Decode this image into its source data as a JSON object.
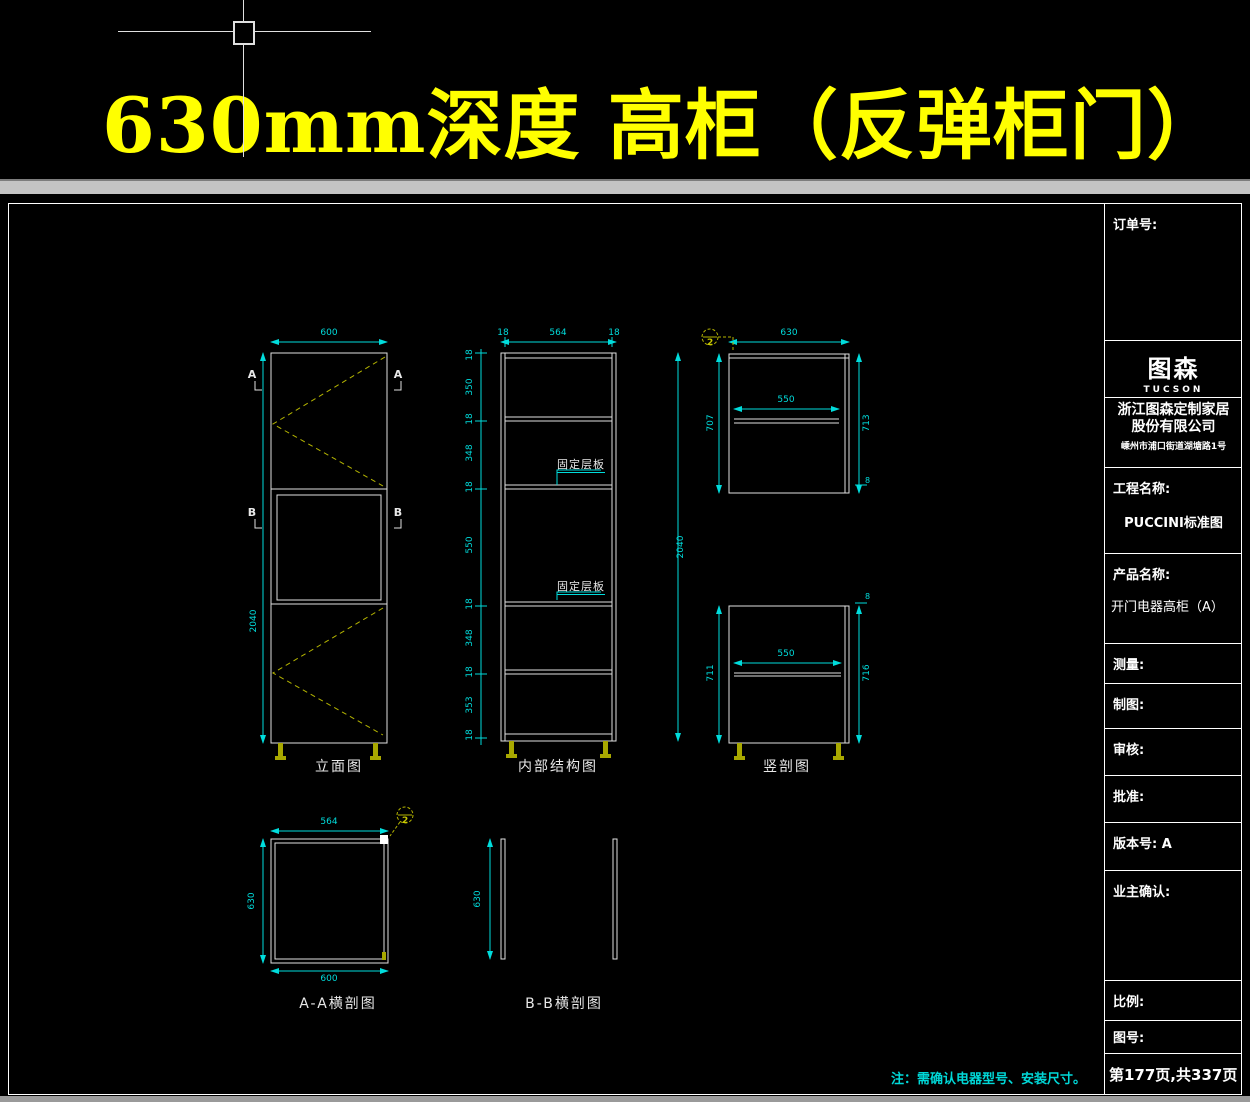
{
  "banner": "630mm深度 高柜（反弹柜门）",
  "note": "注：需确认电器型号、安装尺寸。",
  "colors": {
    "banner_yellow": "#ffff00",
    "dimension_cyan": "#00dcdc",
    "hatch_yellow": "#b4b400"
  },
  "views": {
    "elevation": {
      "label": "立面图",
      "dim_width": "600",
      "dim_height": "2040",
      "marker_a": "A",
      "marker_b": "B"
    },
    "internal": {
      "label": "内部结构图",
      "dim_top_left": "18",
      "dim_top_mid": "564",
      "dim_top_right": "18",
      "dim_right": "2040",
      "shelf_label": "固定层板",
      "left_chain": [
        "18",
        "350",
        "18",
        "348",
        "18",
        "550",
        "18",
        "348",
        "18",
        "353",
        "18"
      ]
    },
    "vertical_section": {
      "label": "竖剖图",
      "callout": "2",
      "upper": {
        "dim_top": "630",
        "dim_left": "707",
        "dim_mid": "550",
        "dim_right": "713",
        "dim_gap": "8"
      },
      "lower": {
        "dim_left": "711",
        "dim_mid": "550",
        "dim_right": "716",
        "dim_gap": "8"
      }
    },
    "section_aa": {
      "label": "A-A横剖图",
      "dim_top": "564",
      "dim_left": "630",
      "dim_bottom": "600",
      "callout": "2"
    },
    "section_bb": {
      "label": "B-B横剖图",
      "dim_left": "630"
    }
  },
  "titleblock": {
    "order_no": "订单号:",
    "logo_cn": "图森",
    "logo_en": "TUCSON",
    "company_line1": "浙江图森定制家居",
    "company_line2": "股份有限公司",
    "company_addr": "嵊州市浦口街道湖塘路1号",
    "project_label": "工程名称:",
    "project_value": "PUCCINI标准图",
    "product_label": "产品名称:",
    "product_value": "开门电器高柜（A）",
    "measure": "测量:",
    "draft": "制图:",
    "review": "审核:",
    "approve": "批准:",
    "version": "版本号: A",
    "owner_confirm": "业主确认:",
    "scale": "比例:",
    "drawing_no": "图号:",
    "page": "第177页,共337页"
  }
}
